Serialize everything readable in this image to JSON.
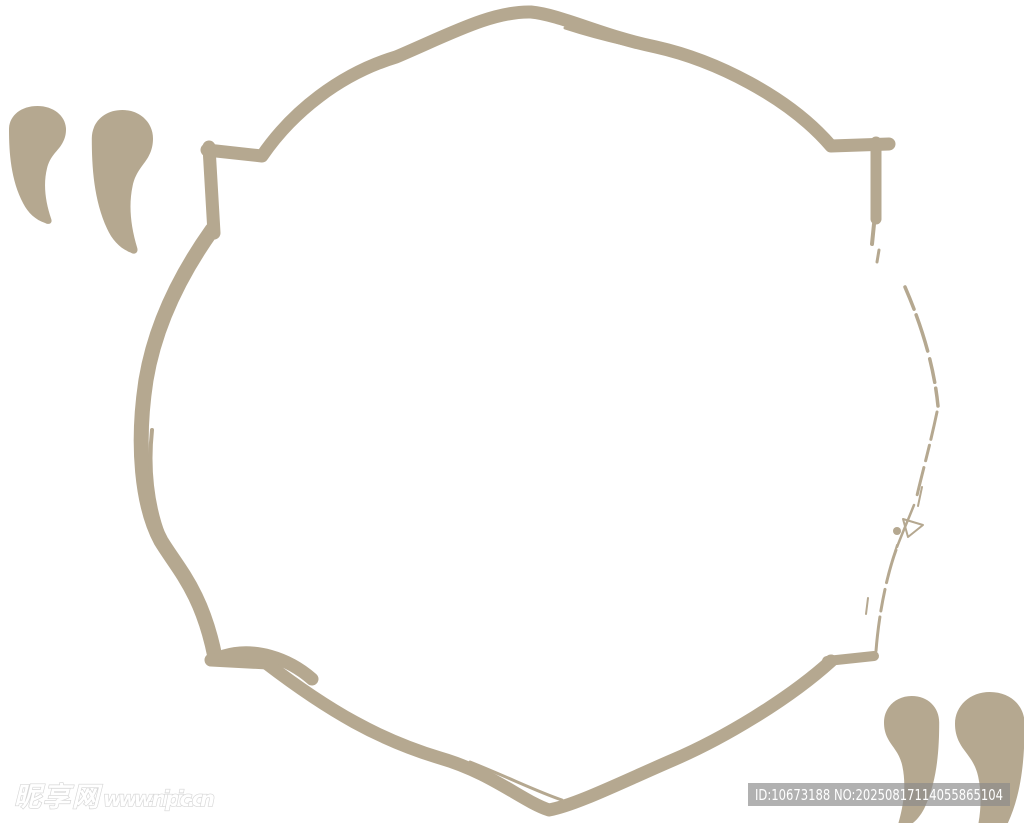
{
  "colors": {
    "tan": "#b5a890",
    "background": "#ffffff",
    "watermark_bar": "#8a8a8a",
    "watermark_text": "#ffffff",
    "watermark_outline": "#d6d6d6"
  },
  "graphic": {
    "description": "hand-drawn brush quatrefoil badge frame with quotation marks"
  },
  "watermarks": {
    "left": {
      "site_name": "昵享网",
      "site_url": "www.nipic.cn"
    },
    "right": {
      "id_label": "ID:10673188 NO:20250817114055865104"
    }
  }
}
